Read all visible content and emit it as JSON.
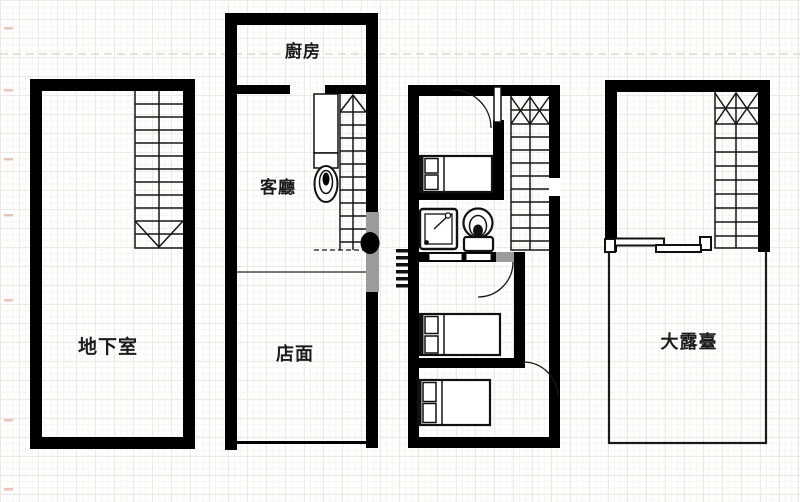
{
  "floorplan": {
    "background_color": "#ffffff",
    "wall_color": "#000000",
    "grid_color": "#edeae3",
    "watermark_color": "#9b9b9b",
    "rooms": {
      "basement": {
        "label": "地下室"
      },
      "kitchen": {
        "label": "廚房"
      },
      "living_room": {
        "label": "客廳"
      },
      "storefront": {
        "label": "店面"
      },
      "terrace": {
        "label": "大露臺"
      }
    },
    "icons": {
      "staircase": "staircase-icon",
      "bed": "bed-icon",
      "toilet": "toilet-icon",
      "shower": "shower-icon",
      "door_swing": "door-arc-icon",
      "sliding_door": "sliding-door-icon",
      "ladder_hatch": "ladder-hatch-icon"
    }
  }
}
